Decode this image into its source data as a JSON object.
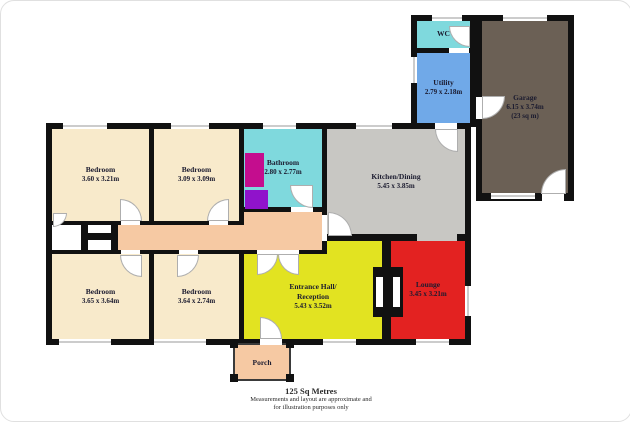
{
  "footer": {
    "area_total": "125 Sq Metres",
    "disclaimer_line1": "Measurements and layout are approximate and",
    "disclaimer_line2": "for illustration purposes only"
  },
  "rooms": {
    "bedroom_top_left": {
      "label": "Bedroom",
      "dims": "3.60 x 3.21m",
      "color": "#F8EACB"
    },
    "bedroom_top_mid": {
      "label": "Bedroom",
      "dims": "3.09 x 3.09m",
      "color": "#F8EACB"
    },
    "bedroom_bottom_left": {
      "label": "Bedroom",
      "dims": "3.65 x 3.64m",
      "color": "#F8EACB"
    },
    "bedroom_bottom_mid": {
      "label": "Bedroom",
      "dims": "3.64 x 2.74m",
      "color": "#F8EACB"
    },
    "bathroom": {
      "label": "Bathroom",
      "dims": "2.80 x 2.77m",
      "color": "#7FD9DD"
    },
    "kitchen_dining": {
      "label": "Kitchen/Dining",
      "dims": "5.45 x 3.85m",
      "color": "#C8C7C3"
    },
    "entrance_hall": {
      "label_line1": "Entrance Hall/",
      "label_line2": "Reception",
      "dims": "5.43 x 3.52m",
      "color": "#E2E321"
    },
    "lounge": {
      "label": "Lounge",
      "dims": "3.45 x 3.21m",
      "color": "#E32221"
    },
    "porch": {
      "label": "Porch",
      "color": "#F6C9A3"
    },
    "wc": {
      "label": "WC",
      "color": "#7FD9DD"
    },
    "utility": {
      "label": "Utility",
      "dims": "2.79 x 2.18m",
      "color": "#70A9E8"
    },
    "garage": {
      "label": "Garage",
      "dims": "6.15 x 3.74m",
      "area_note": "(23 sq m)",
      "color": "#6B6055"
    },
    "hallway": {
      "color": "#F6C9A3"
    }
  },
  "fixtures": {
    "bath_color": "#C40D8E",
    "toilet_color": "#9013CB",
    "wall_color": "#111111"
  }
}
